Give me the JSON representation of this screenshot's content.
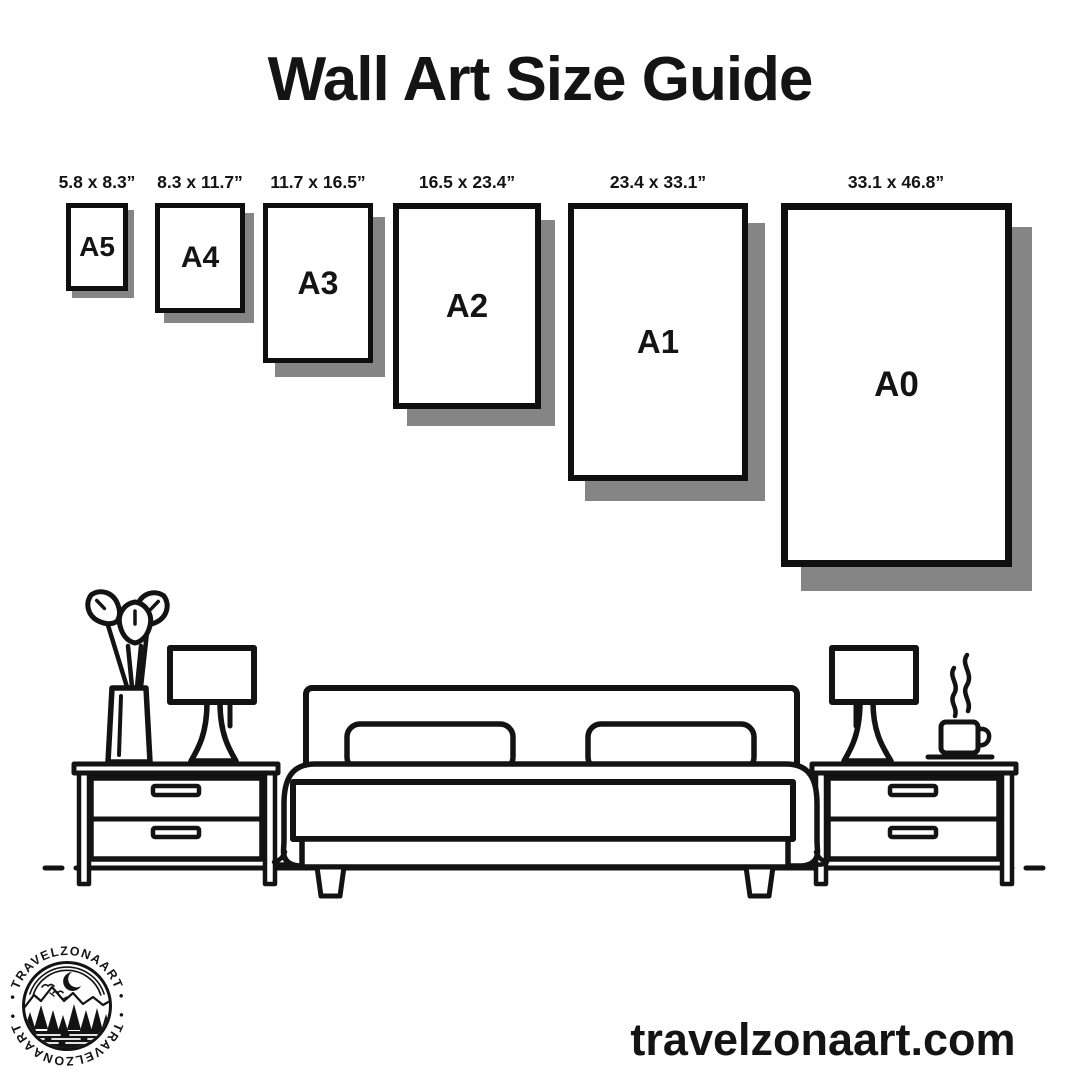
{
  "title": "Wall Art Size Guide",
  "sizes": [
    {
      "code": "A5",
      "dimensions": "5.8 x 8.3”"
    },
    {
      "code": "A4",
      "dimensions": "8.3 x 11.7”"
    },
    {
      "code": "A3",
      "dimensions": "11.7 x 16.5”"
    },
    {
      "code": "A2",
      "dimensions": "16.5 x 23.4”"
    },
    {
      "code": "A1",
      "dimensions": "23.4 x 33.1”"
    },
    {
      "code": "A0",
      "dimensions": "33.1 x 46.8”"
    }
  ],
  "logo": {
    "arc_text_top": "• TRAVELZONAART •",
    "arc_text_bottom": "• TRAVELZONAART •"
  },
  "website": "travelzonaart.com",
  "colors": {
    "ink": "#131313",
    "shadow": "#858585",
    "background": "#ffffff"
  }
}
